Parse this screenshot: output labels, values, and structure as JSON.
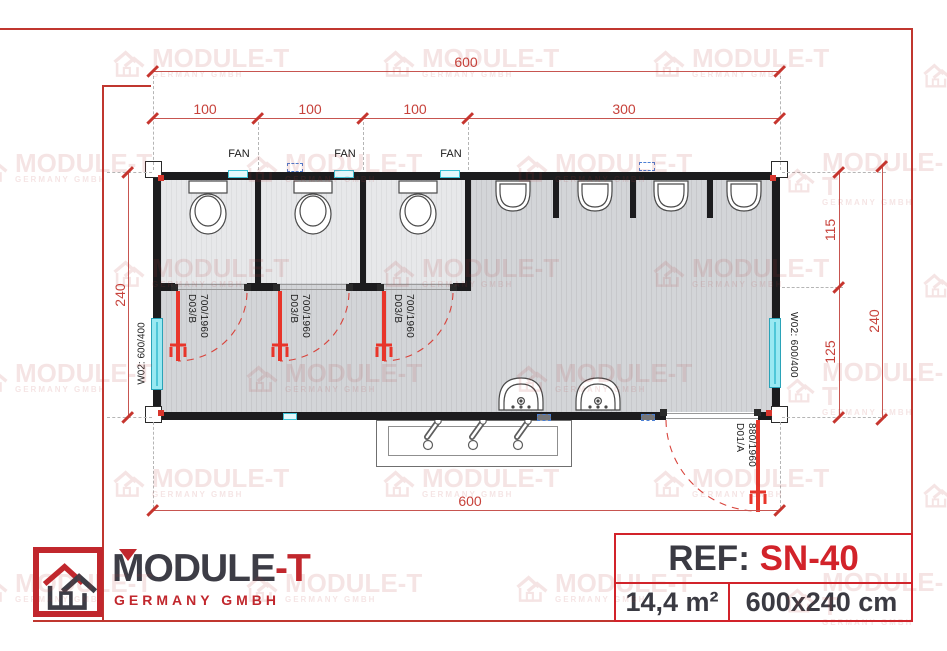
{
  "watermark": {
    "brand": "MODULE-T",
    "subtitle": "GERMANY GMBH"
  },
  "plan": {
    "dims": {
      "top_total": "600",
      "segments": [
        "100",
        "100",
        "100",
        "300"
      ],
      "left_total": "240",
      "right_upper": "115",
      "right_lower": "125",
      "right_total": "240",
      "bottom_total": "600"
    },
    "fan_labels": [
      "FAN",
      "FAN",
      "FAN"
    ],
    "doors": {
      "stall_type": "D03/B",
      "stall_size": "700/1960",
      "entry_type": "D01/A",
      "entry_size": "880/1960"
    },
    "windows": {
      "left_label": "W02: 600/400",
      "right_label": "W02: 600/400"
    }
  },
  "footer": {
    "logo": {
      "brand_main": "MODULE",
      "brand_accent": "-T",
      "subtitle": "GERMANY GMBH"
    },
    "ref": {
      "label": "REF: ",
      "value": "SN-40",
      "area": "14,4 m²",
      "size": "600x240 cm"
    }
  },
  "colors": {
    "dim_red": "#c7423b",
    "door_red": "#e8352a",
    "logo_red": "#c1272d",
    "ref_red": "#d2232a",
    "wall_black": "#1c1c1e",
    "window_cyan": "#9ae9f2"
  }
}
